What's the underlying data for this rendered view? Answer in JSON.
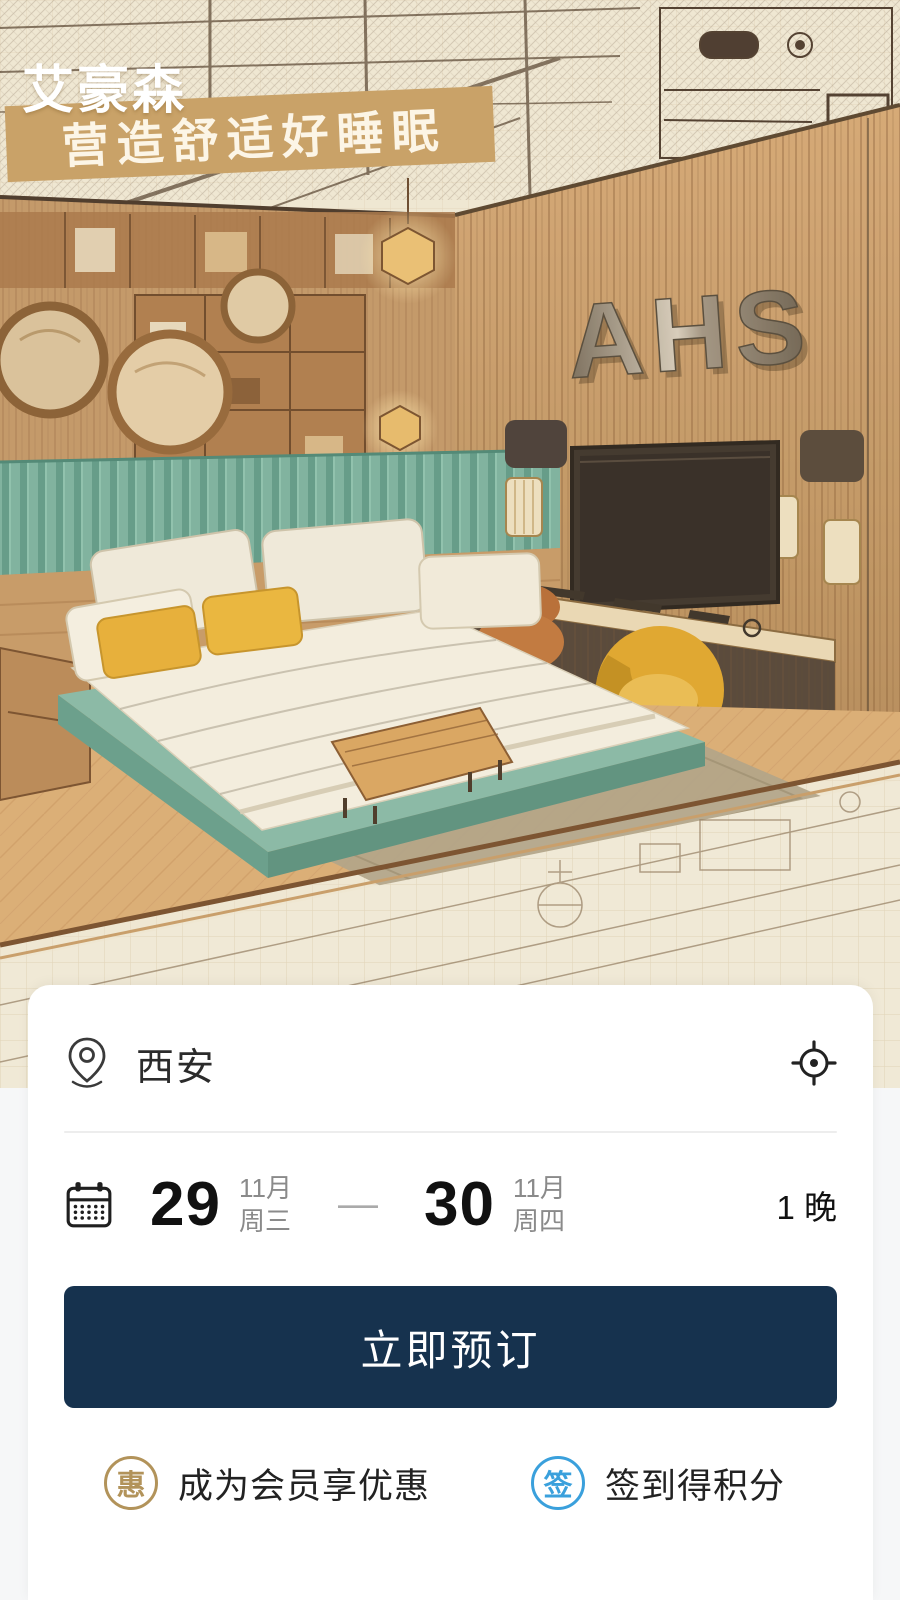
{
  "hero": {
    "logo_text": "艾豪森",
    "logo_subtext": "AIHAOSEN HOTEL",
    "slogan": "营造舒适好睡眠",
    "sign_text": "AHS"
  },
  "booking": {
    "city": "西安",
    "checkin": {
      "day": "29",
      "month": "11月",
      "weekday": "周三"
    },
    "checkout": {
      "day": "30",
      "month": "11月",
      "weekday": "周四"
    },
    "range_separator": "—",
    "nights": "1 晚",
    "book_button": "立即预订",
    "perks": [
      {
        "icon_char": "惠",
        "label": "成为会员享优惠"
      },
      {
        "icon_char": "签",
        "label": "签到得积分"
      }
    ]
  },
  "colors": {
    "button_navy": "#16324e",
    "banner_tan": "#c9a268",
    "perk_gold": "#b2935a",
    "perk_blue": "#3aa0dc",
    "headboard_teal": "#7eb5a3",
    "accent_yellow": "#e9b23a"
  }
}
